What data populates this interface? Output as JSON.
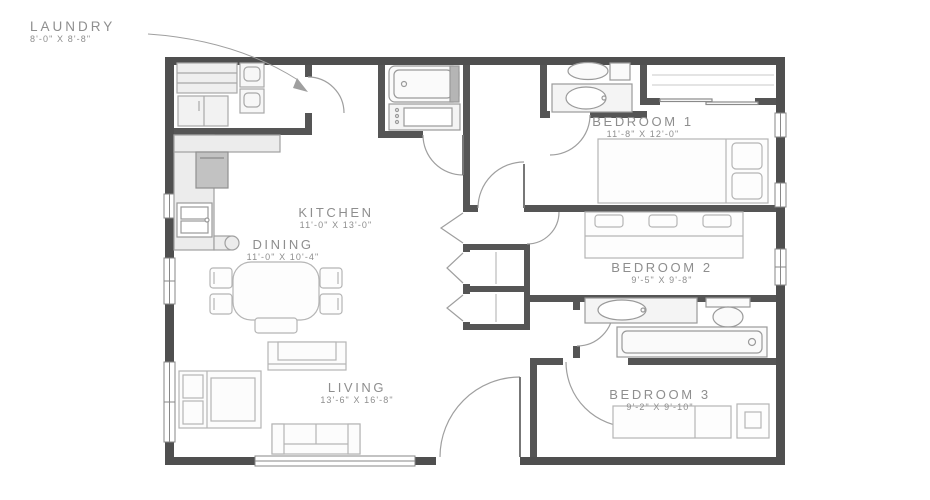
{
  "plan_title": "apartment-floor-plan",
  "rooms": {
    "laundry": {
      "name": "LAUNDRY",
      "dims": "8'-0\" X 8'-8\""
    },
    "kitchen": {
      "name": "KITCHEN",
      "dims": "11'-0\" X 13'-0\""
    },
    "dining": {
      "name": "DINING",
      "dims": "11'-0\" X 10'-4\""
    },
    "living": {
      "name": "LIVING",
      "dims": "13'-6\" X 16'-8\""
    },
    "bedroom1": {
      "name": "BEDROOM 1",
      "dims": "11'-8\" X 12'-0\""
    },
    "bedroom2": {
      "name": "BEDROOM 2",
      "dims": "9'-5\" X 9'-8\""
    },
    "bedroom3": {
      "name": "BEDROOM 3",
      "dims": "9'-2\" X 9'-10\""
    }
  },
  "colors": {
    "background": "#ffffff",
    "exterior_wall": "#4f4f4f",
    "interior_wall": "#555555",
    "furniture_line": "#b2b2b2",
    "fixture_line": "#9c9c9c",
    "counter_fill": "#ececec",
    "appliance_fill": "#c2c2c2",
    "door_arc": "#9f9f9f",
    "window_frame": "#878787",
    "label_text": "#8e8e8e"
  }
}
